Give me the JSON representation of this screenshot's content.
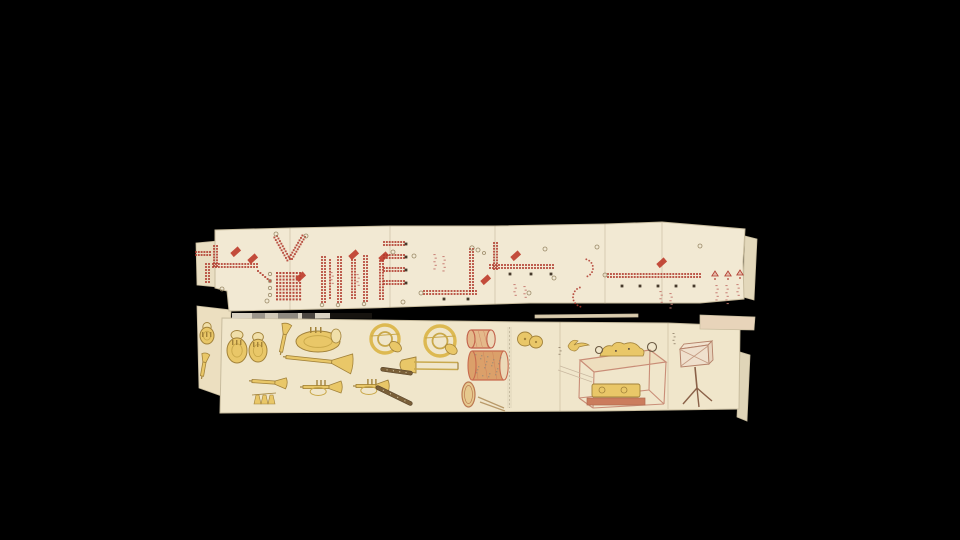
{
  "scene": {
    "title": "Photograph of two unrolled scroll sections on a black background: the upper scroll bears red-dot band formation diagrams with small flags and annotations; the lower scroll bears hand-drawn brass instruments, drums, cymbals, a glass display case and a box on a tripod stand",
    "background_color": "#000000",
    "width": 960,
    "height": 540
  },
  "palette": {
    "paper_top": "#f2e9d3",
    "paper_bottom": "#f0e6cb",
    "sheet_edge": "#c8bc9e",
    "seam": "rgba(150,130,95,0.35)",
    "dot_red": "#b03a2e",
    "flag_red": "#bf3e2e",
    "marker_dark": "#463a2b",
    "circle_stroke": "#9b8a68",
    "tick_red": "#c4766c",
    "tick_dark": "#8c7c64",
    "instrument_fill": "#e9c768",
    "instrument_outline": "#a2823a",
    "instrument_detail": "#c9a84a",
    "instrument_pale": "#f0dfa9",
    "dark_wind": "#7a5f38",
    "drum_snare_body": "#e4b98a",
    "drum_snare_rim": "#c2604a",
    "drum_bass_body": "#dba06a",
    "drum_bass_rim": "#c86a4e",
    "case_pink": "#c98d77",
    "case_base": "#cb7c5d",
    "stand_brown": "#8a6148"
  },
  "fragments": [
    {
      "name": "fragment-top-left",
      "layer": "back",
      "color": "#e9dec2",
      "points": [
        [
          196,
          243
        ],
        [
          218,
          241
        ],
        [
          218,
          287
        ],
        [
          197,
          285
        ]
      ]
    },
    {
      "name": "fragment-right-top-sliver",
      "layer": "back",
      "color": "#e3d8bb",
      "points": [
        [
          745,
          236
        ],
        [
          757,
          239
        ],
        [
          754,
          300
        ],
        [
          743,
          297
        ]
      ]
    },
    {
      "name": "fragment-right-bottom-sliver",
      "layer": "back",
      "color": "#e0d5b8",
      "points": [
        [
          740,
          352
        ],
        [
          750,
          355
        ],
        [
          747,
          421
        ],
        [
          737,
          417
        ]
      ]
    },
    {
      "name": "fragment-bottom-left",
      "layer": "back",
      "color": "#ecdfc0",
      "points": [
        [
          197,
          306
        ],
        [
          231,
          310
        ],
        [
          227,
          398
        ],
        [
          199,
          388
        ]
      ]
    },
    {
      "name": "fragment-right-band",
      "layer": "front",
      "color": "#e8d4ba",
      "points": [
        [
          700,
          315
        ],
        [
          755,
          317
        ],
        [
          754,
          330
        ],
        [
          700,
          329
        ]
      ]
    },
    {
      "name": "fragment-edge-line",
      "layer": "front",
      "color": "#d9cbae",
      "points": [
        [
          535,
          315
        ],
        [
          638,
          314
        ],
        [
          638,
          317
        ],
        [
          535,
          318
        ]
      ]
    }
  ],
  "top_scroll": {
    "name": "formation-diagram-scroll",
    "paper_color": "#f2e9d3",
    "outline": [
      [
        215,
        230
      ],
      [
        290,
        228
      ],
      [
        390,
        226
      ],
      [
        495,
        226
      ],
      [
        605,
        224
      ],
      [
        662,
        222
      ],
      [
        745,
        229
      ],
      [
        743,
        262
      ],
      [
        744,
        299
      ],
      [
        700,
        303
      ],
      [
        530,
        303
      ],
      [
        430,
        306
      ],
      [
        370,
        308
      ],
      [
        229,
        311
      ],
      [
        227,
        291
      ],
      [
        215,
        288
      ]
    ],
    "seams": [
      {
        "x": 290,
        "y1": 228,
        "y2": 310
      },
      {
        "x": 390,
        "y1": 226,
        "y2": 308
      },
      {
        "x": 495,
        "y1": 226,
        "y2": 304
      },
      {
        "x": 605,
        "y1": 224,
        "y2": 304
      },
      {
        "x": 662,
        "y1": 223,
        "y2": 303
      }
    ],
    "marks": [
      {
        "type": "row",
        "x": 196,
        "y": 252,
        "len": 14,
        "dbl": 2
      },
      {
        "type": "col",
        "x": 206,
        "y": 264,
        "len": 18,
        "dbl": 2
      },
      {
        "type": "col",
        "x": 214,
        "y": 246,
        "len": 20,
        "dbl": 2
      },
      {
        "type": "row",
        "x": 213,
        "y": 264,
        "len": 44,
        "dbl": 2
      },
      {
        "type": "diag",
        "x1": 258,
        "y1": 271,
        "x2": 270,
        "y2": 281,
        "dbl": 1
      },
      {
        "type": "flag",
        "x": 230,
        "y": 252
      },
      {
        "type": "flag",
        "x": 247,
        "y": 259
      },
      {
        "type": "diag",
        "x1": 277,
        "y1": 236,
        "x2": 290,
        "y2": 259,
        "dbl": 2
      },
      {
        "type": "diag",
        "x1": 305,
        "y1": 237,
        "x2": 292,
        "y2": 259,
        "dbl": 2
      },
      {
        "type": "circle",
        "x": 276,
        "y": 234,
        "r": 2
      },
      {
        "type": "circle",
        "x": 306,
        "y": 236,
        "r": 2
      },
      {
        "type": "grid",
        "x": 276,
        "y": 272,
        "cols": 8,
        "rows": 9
      },
      {
        "type": "circle",
        "x": 270,
        "y": 274,
        "r": 1.7
      },
      {
        "type": "circle",
        "x": 270,
        "y": 281,
        "r": 1.7
      },
      {
        "type": "circle",
        "x": 270,
        "y": 288,
        "r": 1.7
      },
      {
        "type": "circle",
        "x": 270,
        "y": 295,
        "r": 1.7
      },
      {
        "type": "flag",
        "x": 295,
        "y": 277
      },
      {
        "type": "col",
        "x": 322,
        "y": 257,
        "len": 45,
        "dbl": 2
      },
      {
        "type": "col",
        "x": 330,
        "y": 260,
        "len": 38,
        "dbl": 1
      },
      {
        "type": "col",
        "x": 338,
        "y": 257,
        "len": 45,
        "dbl": 2
      },
      {
        "type": "col",
        "x": 352,
        "y": 260,
        "len": 38,
        "dbl": 2
      },
      {
        "type": "col",
        "x": 364,
        "y": 256,
        "len": 45,
        "dbl": 2
      },
      {
        "type": "col",
        "x": 380,
        "y": 261,
        "len": 38,
        "dbl": 2
      },
      {
        "type": "flag",
        "x": 348,
        "y": 255
      },
      {
        "type": "flag",
        "x": 378,
        "y": 257
      },
      {
        "type": "ticks",
        "x": 331,
        "y": 272,
        "n": 4,
        "c": "red"
      },
      {
        "type": "ticks",
        "x": 357,
        "y": 274,
        "n": 4,
        "c": "red"
      },
      {
        "type": "circle",
        "x": 322,
        "y": 305,
        "r": 1.8
      },
      {
        "type": "circle",
        "x": 338,
        "y": 305,
        "r": 1.8
      },
      {
        "type": "circle",
        "x": 364,
        "y": 304,
        "r": 1.8
      },
      {
        "type": "row",
        "x": 384,
        "y": 242,
        "len": 20,
        "dbl": 2
      },
      {
        "type": "row",
        "x": 384,
        "y": 255,
        "len": 20,
        "dbl": 2
      },
      {
        "type": "row",
        "x": 384,
        "y": 268,
        "len": 20,
        "dbl": 2
      },
      {
        "type": "row",
        "x": 384,
        "y": 281,
        "len": 20,
        "dbl": 2
      },
      {
        "type": "marker",
        "x": 406,
        "y": 244
      },
      {
        "type": "marker",
        "x": 406,
        "y": 257
      },
      {
        "type": "marker",
        "x": 406,
        "y": 270
      },
      {
        "type": "marker",
        "x": 406,
        "y": 283
      },
      {
        "type": "circle",
        "x": 414,
        "y": 256,
        "r": 2
      },
      {
        "type": "ticks",
        "x": 434,
        "y": 254,
        "n": 5,
        "c": "red"
      },
      {
        "type": "ticks",
        "x": 443,
        "y": 256,
        "n": 5,
        "c": "red"
      },
      {
        "type": "col",
        "x": 470,
        "y": 249,
        "len": 42,
        "dbl": 2
      },
      {
        "type": "row",
        "x": 424,
        "y": 291,
        "len": 52,
        "dbl": 2
      },
      {
        "type": "marker",
        "x": 444,
        "y": 299
      },
      {
        "type": "marker",
        "x": 468,
        "y": 299
      },
      {
        "type": "circle",
        "x": 478,
        "y": 250,
        "r": 2
      },
      {
        "type": "circle",
        "x": 484,
        "y": 253,
        "r": 1.5
      },
      {
        "type": "flag",
        "x": 480,
        "y": 280
      },
      {
        "type": "circle",
        "x": 421,
        "y": 293,
        "r": 2
      },
      {
        "type": "col",
        "x": 494,
        "y": 243,
        "len": 26,
        "dbl": 2
      },
      {
        "type": "row",
        "x": 490,
        "y": 265,
        "len": 63,
        "dbl": 2
      },
      {
        "type": "flag",
        "x": 510,
        "y": 256
      },
      {
        "type": "marker",
        "x": 510,
        "y": 274
      },
      {
        "type": "marker",
        "x": 531,
        "y": 274
      },
      {
        "type": "marker",
        "x": 551,
        "y": 274
      },
      {
        "type": "circle",
        "x": 472,
        "y": 248,
        "r": 2.2
      },
      {
        "type": "circle",
        "x": 554,
        "y": 278,
        "r": 2
      },
      {
        "type": "ticks",
        "x": 514,
        "y": 284,
        "n": 4,
        "c": "red"
      },
      {
        "type": "ticks",
        "x": 524,
        "y": 286,
        "n": 4,
        "c": "red"
      },
      {
        "type": "arc",
        "cx": 584,
        "cy": 268,
        "r": 9,
        "a1": -75,
        "a2": 75
      },
      {
        "type": "arc",
        "cx": 583,
        "cy": 297,
        "r": 10,
        "a1": 105,
        "a2": 255
      },
      {
        "type": "circle",
        "x": 529,
        "y": 293,
        "r": 2
      },
      {
        "type": "circle",
        "x": 597,
        "y": 247,
        "r": 2
      },
      {
        "type": "row",
        "x": 608,
        "y": 274,
        "len": 92,
        "dbl": 2
      },
      {
        "type": "circle",
        "x": 605,
        "y": 275,
        "r": 2
      },
      {
        "type": "flag",
        "x": 656,
        "y": 263
      },
      {
        "type": "marker",
        "x": 622,
        "y": 286
      },
      {
        "type": "marker",
        "x": 640,
        "y": 286
      },
      {
        "type": "marker",
        "x": 658,
        "y": 286
      },
      {
        "type": "marker",
        "x": 676,
        "y": 286
      },
      {
        "type": "marker",
        "x": 694,
        "y": 286
      },
      {
        "type": "ticks",
        "x": 660,
        "y": 291,
        "n": 4,
        "c": "red"
      },
      {
        "type": "ticks",
        "x": 670,
        "y": 293,
        "n": 5,
        "c": "red"
      },
      {
        "type": "tri",
        "x": 715,
        "y": 276
      },
      {
        "type": "tri",
        "x": 728,
        "y": 276
      },
      {
        "type": "tri",
        "x": 740,
        "y": 275
      },
      {
        "type": "ticks",
        "x": 716,
        "y": 285,
        "n": 5,
        "c": "red"
      },
      {
        "type": "ticks",
        "x": 726,
        "y": 285,
        "n": 6,
        "c": "red"
      },
      {
        "type": "ticks",
        "x": 737,
        "y": 284,
        "n": 4,
        "c": "red"
      },
      {
        "type": "circle",
        "x": 222,
        "y": 289,
        "r": 2
      },
      {
        "type": "circle",
        "x": 267,
        "y": 301,
        "r": 2
      },
      {
        "type": "circle",
        "x": 393,
        "y": 252,
        "r": 2
      },
      {
        "type": "circle",
        "x": 403,
        "y": 302,
        "r": 2
      },
      {
        "type": "circle",
        "x": 545,
        "y": 249,
        "r": 2
      },
      {
        "type": "circle",
        "x": 700,
        "y": 246,
        "r": 2
      }
    ]
  },
  "calibration_bar": {
    "name": "grayscale-reference-strip",
    "x": 232,
    "y": 313,
    "height": 5.5,
    "segments": [
      {
        "w": 20,
        "color": "#d9d2c2"
      },
      {
        "w": 13,
        "color": "#9b958b"
      },
      {
        "w": 13,
        "color": "#d0c8b7"
      },
      {
        "w": 20,
        "color": "#8e8980"
      },
      {
        "w": 4,
        "color": "#d9d2c2"
      },
      {
        "w": 13,
        "color": "#4b4641"
      },
      {
        "w": 15,
        "color": "#d9d2c2"
      },
      {
        "w": 42,
        "color": "#16130f"
      }
    ]
  },
  "bottom_scroll": {
    "name": "instrument-scroll",
    "paper_color": "#f0e6cb",
    "outline": [
      [
        222,
        318
      ],
      [
        370,
        320
      ],
      [
        530,
        322
      ],
      [
        668,
        323
      ],
      [
        740,
        326
      ],
      [
        739,
        409
      ],
      [
        600,
        411
      ],
      [
        400,
        412
      ],
      [
        220,
        413
      ]
    ],
    "seams": [
      {
        "x": 560,
        "y1": 322,
        "y2": 411
      },
      {
        "x": 668,
        "y1": 323,
        "y2": 409
      }
    ],
    "light_band": {
      "x": 507,
      "y1": 327,
      "y2": 408,
      "w": 5
    },
    "items": [
      {
        "type": "tuba",
        "x": 200,
        "y": 322,
        "w": 14,
        "h": 22
      },
      {
        "type": "trumpet",
        "x": 202,
        "y": 376,
        "len": 22,
        "angle": -80,
        "bell": 8
      },
      {
        "type": "tuba",
        "x": 227,
        "y": 330,
        "w": 20,
        "h": 33
      },
      {
        "type": "tuba",
        "x": 249,
        "y": 332,
        "w": 18,
        "h": 30
      },
      {
        "type": "trumpet",
        "x": 281,
        "y": 352,
        "len": 28,
        "angle": -78,
        "bell": 10
      },
      {
        "type": "euph",
        "x": 296,
        "y": 331,
        "w": 44,
        "h": 21
      },
      {
        "type": "trumpet",
        "x": 286,
        "y": 357,
        "len": 66,
        "angle": 6,
        "bell": 20
      },
      {
        "type": "horn",
        "x": 385,
        "y": 339,
        "r": 14
      },
      {
        "type": "horn",
        "x": 440,
        "y": 341,
        "r": 15
      },
      {
        "type": "trombone",
        "x": 400,
        "y": 364,
        "len": 58
      },
      {
        "type": "trumpet",
        "x": 252,
        "y": 381,
        "len": 34,
        "angle": 4,
        "bell": 11
      },
      {
        "type": "bells",
        "x": 254,
        "y": 394
      },
      {
        "type": "cornet",
        "x": 303,
        "y": 387,
        "len": 38
      },
      {
        "type": "cornet",
        "x": 356,
        "y": 386,
        "len": 32
      },
      {
        "type": "darkwind",
        "x": 381,
        "y": 367,
        "len": 32,
        "angle": 8
      },
      {
        "type": "darkwind",
        "x": 377,
        "y": 385,
        "len": 40,
        "angle": 26
      },
      {
        "type": "drum",
        "x": 467,
        "y": 330,
        "w": 28,
        "h": 18,
        "body": "#e4b98a",
        "rim": "#c2604a",
        "mottle": false
      },
      {
        "type": "drum",
        "x": 468,
        "y": 351,
        "w": 40,
        "h": 29,
        "body": "#dba06a",
        "rim": "#c86a4e",
        "mottle": true
      },
      {
        "type": "smalldrum",
        "x": 462,
        "y": 382,
        "w": 13,
        "h": 25
      },
      {
        "type": "sticks",
        "x": 478,
        "y": 397
      },
      {
        "type": "cymbals",
        "x": 517,
        "y": 331
      },
      {
        "type": "bird",
        "x": 568,
        "y": 338
      },
      {
        "type": "ticksd",
        "x": 559,
        "y": 347,
        "n": 3
      },
      {
        "type": "case",
        "x": 578,
        "y": 338
      },
      {
        "type": "ticksd",
        "x": 673,
        "y": 333,
        "n": 4
      },
      {
        "type": "stand",
        "x": 680,
        "y": 343
      }
    ]
  }
}
